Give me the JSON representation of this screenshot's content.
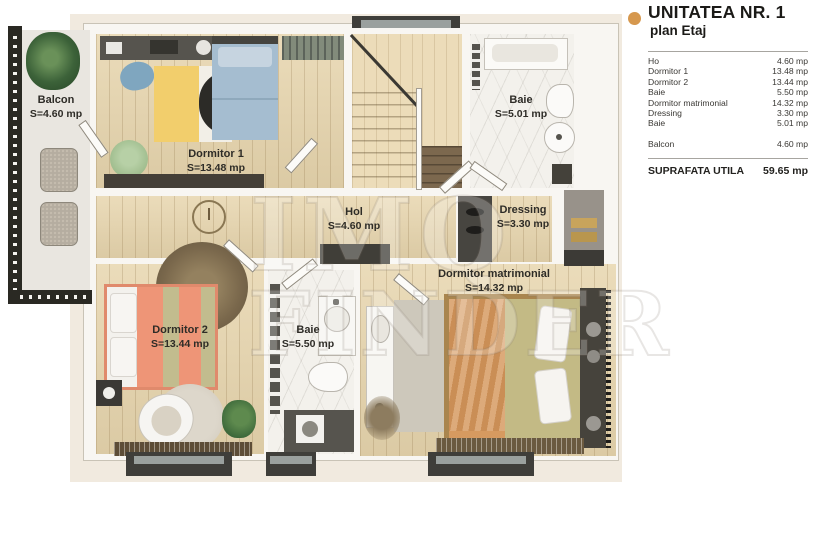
{
  "colors": {
    "accent_orange": "#d6984e",
    "plan_cream": "#f1eadf",
    "wood_floor": "#e7d5ad"
  },
  "legend": {
    "title": "UNITATEA NR. 1",
    "subtitle": "plan Etaj",
    "rows": [
      {
        "label": "Ho",
        "value": "4.60 mp"
      },
      {
        "label": "Dormitor 1",
        "value": "13.48 mp"
      },
      {
        "label": "Dormitor 2",
        "value": "13.44 mp"
      },
      {
        "label": "Baie",
        "value": "5.50 mp"
      },
      {
        "label": "Dormitor matrimonial",
        "value": "14.32 mp"
      },
      {
        "label": "Dressing",
        "value": "3.30 mp"
      },
      {
        "label": "Baie",
        "value": "5.01 mp"
      }
    ],
    "balcony_row": {
      "label": "Balcon",
      "value": "4.60 mp"
    },
    "total": {
      "label": "SUPRAFATA UTILA",
      "value": "59.65 mp"
    }
  },
  "plan": {
    "watermark": {
      "line1": "IMQ",
      "line2": "FINDER"
    },
    "rooms": [
      {
        "id": "balcon",
        "name": "Balcon",
        "area": "S=4.60 mp"
      },
      {
        "id": "dormitor-1",
        "name": "Dormitor 1",
        "area": "S=13.48 mp"
      },
      {
        "id": "baie-etaj",
        "name": "Baie",
        "area": "S=5.01 mp"
      },
      {
        "id": "hol",
        "name": "Hol",
        "area": "S=4.60 mp"
      },
      {
        "id": "dressing",
        "name": "Dressing",
        "area": "S=3.30 mp"
      },
      {
        "id": "dormitor-2",
        "name": "Dormitor 2",
        "area": "S=13.44 mp"
      },
      {
        "id": "baie",
        "name": "Baie",
        "area": "S=5.50 mp"
      },
      {
        "id": "dormitor-matrimonial",
        "name": "Dormitor matrimonial",
        "area": "S=14.32 mp"
      }
    ]
  }
}
